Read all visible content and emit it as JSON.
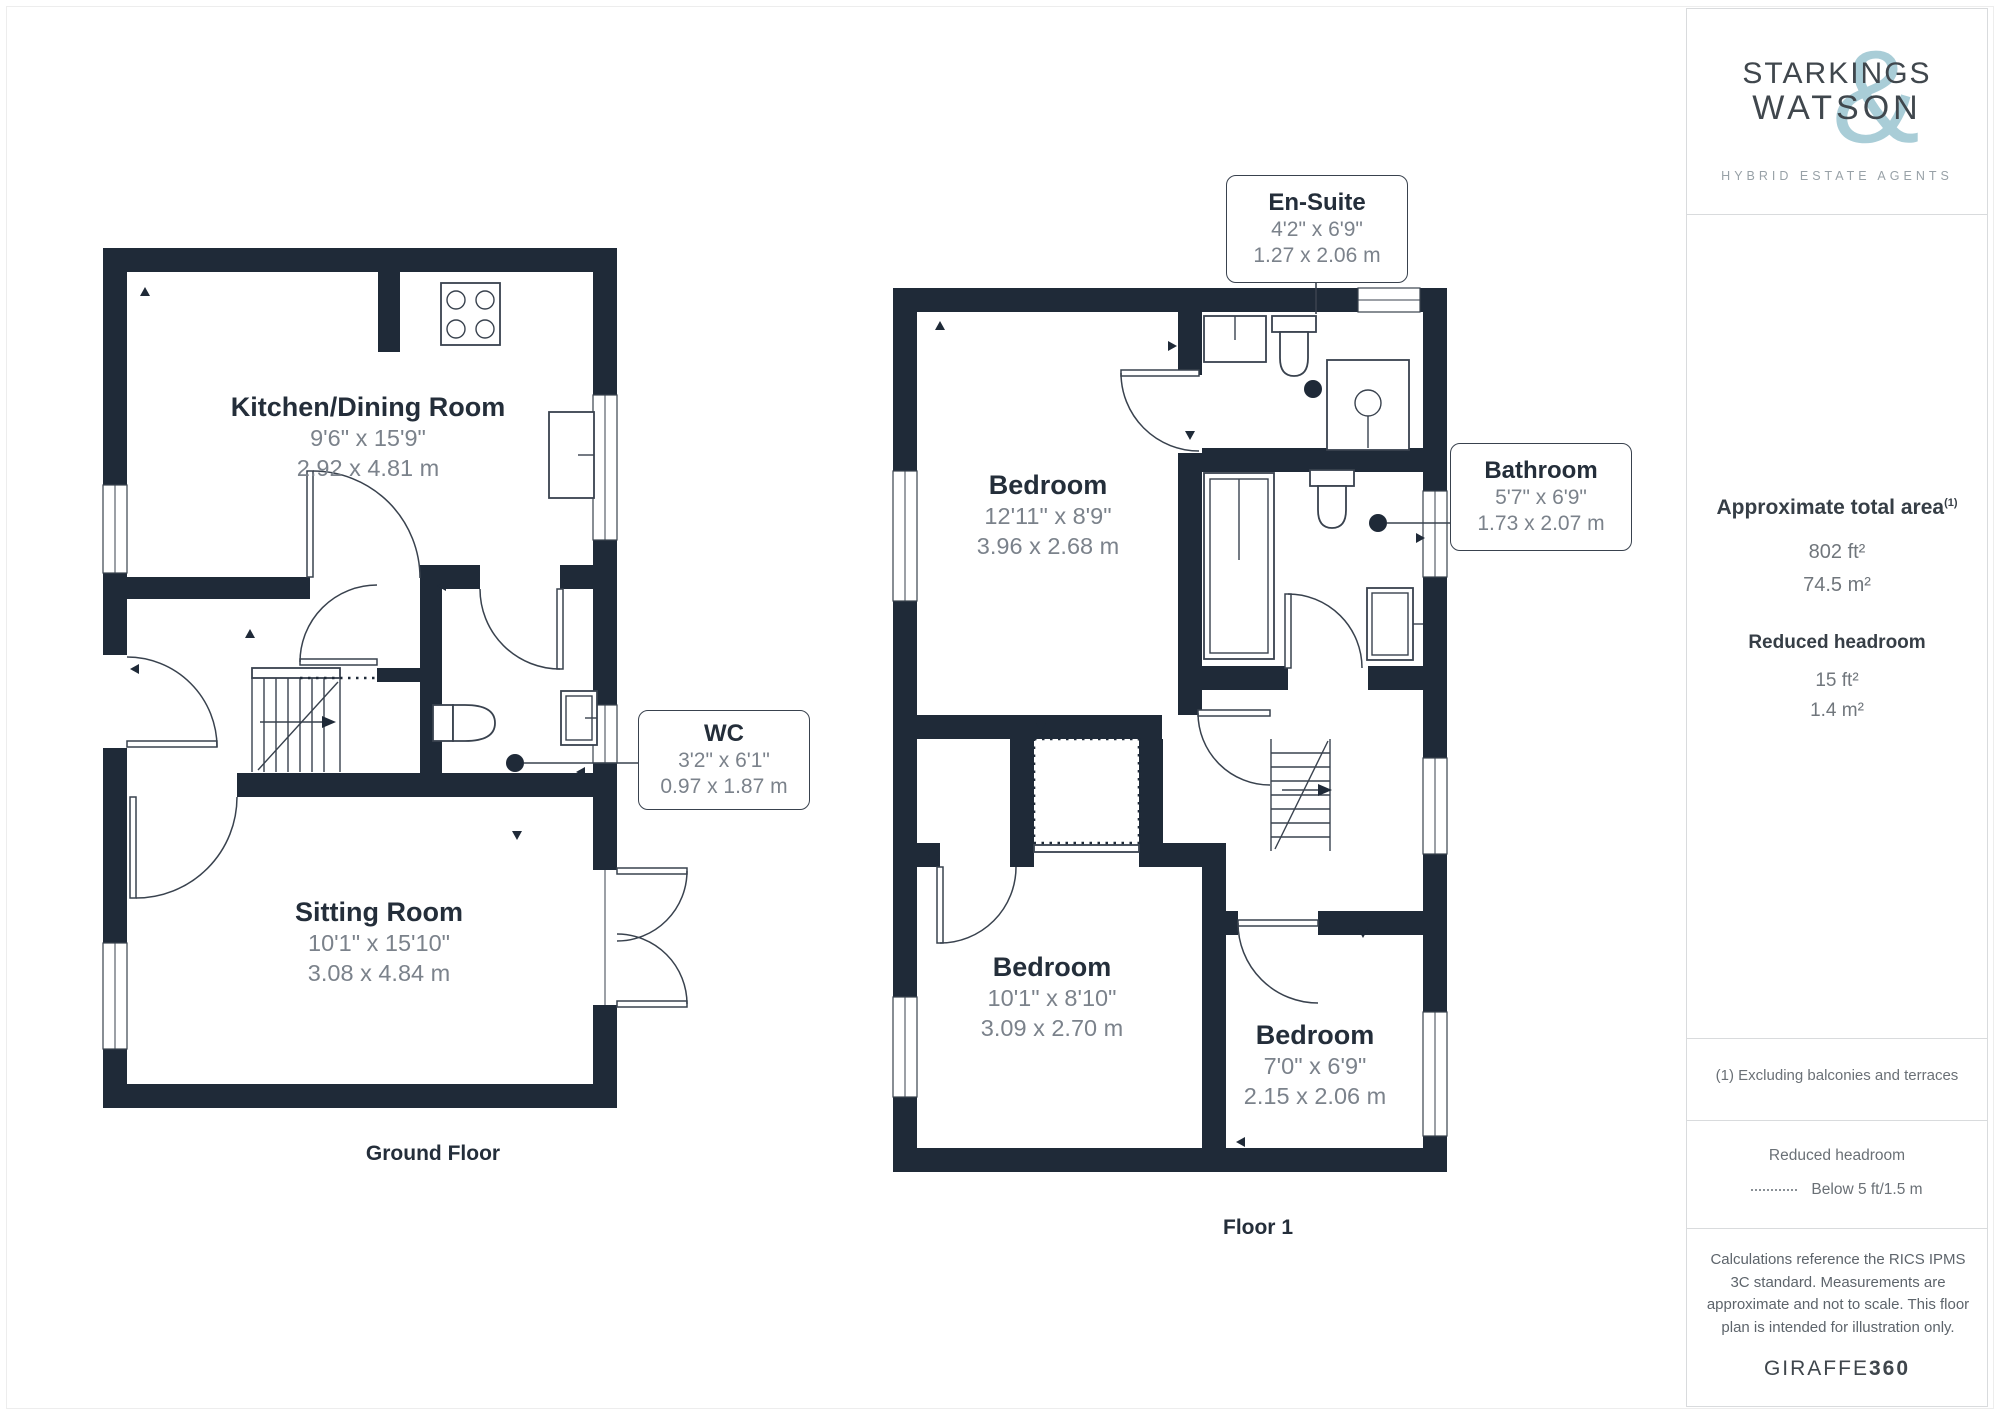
{
  "brand": {
    "line1": "STARKINGS",
    "line2": "WATSON",
    "ampersand": "&",
    "tagline": "HYBRID ESTATE AGENTS"
  },
  "sidebar": {
    "total_area": {
      "title": "Approximate total area",
      "superscript": "(1)",
      "imperial": "802 ft²",
      "metric": "74.5 m²"
    },
    "reduced_headroom": {
      "title": "Reduced headroom",
      "imperial": "15 ft²",
      "metric": "1.4 m²"
    },
    "footnote": "(1) Excluding balconies and terraces",
    "legend": {
      "title": "Reduced headroom",
      "label": "Below 5 ft/1.5 m"
    },
    "disclaimer": "Calculations reference the RICS IPMS 3C standard. Measurements are approximate and not to scale. This floor plan is intended for illustration only.",
    "brand_footer": {
      "name": "GIRAFFE",
      "suffix": "360"
    }
  },
  "floors": [
    {
      "caption": "Ground Floor",
      "rooms": [
        {
          "name": "Kitchen/Dining Room",
          "imperial": "9'6\" x 15'9\"",
          "metric": "2.92 x 4.81 m"
        },
        {
          "name": "Sitting Room",
          "imperial": "10'1\" x 15'10\"",
          "metric": "3.08 x 4.84 m"
        }
      ],
      "callouts": [
        {
          "name": "WC",
          "imperial": "3'2\" x 6'1\"",
          "metric": "0.97 x 1.87 m"
        }
      ]
    },
    {
      "caption": "Floor 1",
      "rooms": [
        {
          "name": "Bedroom",
          "imperial": "12'11\" x 8'9\"",
          "metric": "3.96 x 2.68 m"
        },
        {
          "name": "Bedroom",
          "imperial": "10'1\" x 8'10\"",
          "metric": "3.09 x 2.70 m"
        },
        {
          "name": "Bedroom",
          "imperial": "7'0\" x 6'9\"",
          "metric": "2.15 x 2.06 m"
        }
      ],
      "callouts": [
        {
          "name": "En-Suite",
          "imperial": "4'2\" x 6'9\"",
          "metric": "1.27 x 2.06 m"
        },
        {
          "name": "Bathroom",
          "imperial": "5'7\" x 6'9\"",
          "metric": "1.73 x 2.07 m"
        }
      ]
    }
  ],
  "colors": {
    "wall": "#1f2a38",
    "line": "#39424e",
    "accent": "#a9cdd7",
    "title_text": "#242e3a",
    "dim_text": "#7b828b",
    "muted_text": "#6a7076",
    "divider": "#d9dbdd"
  }
}
